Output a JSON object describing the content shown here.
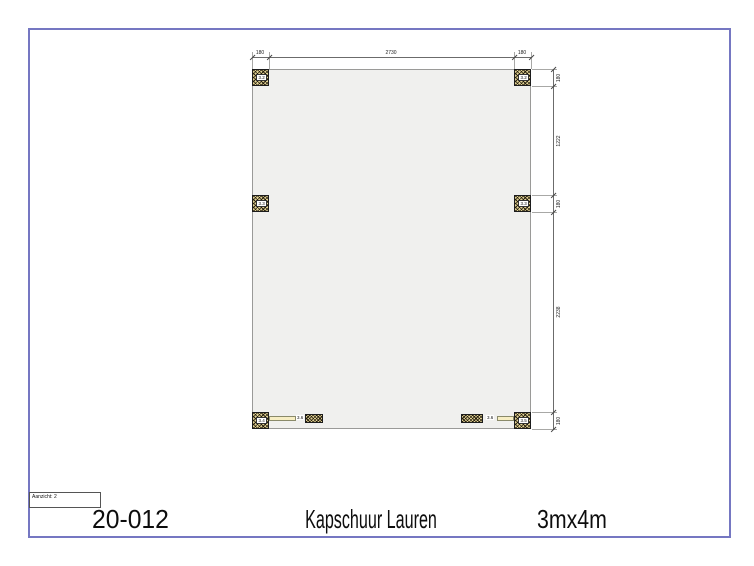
{
  "drawing": {
    "view_box_label": "Aanzicht: 2",
    "footer": {
      "project_number": "20-012",
      "title": "Kapschuur Lauren",
      "size": "3mx4m"
    },
    "colors": {
      "frame_border": "#7577c2",
      "floor_fill": "#f0f0ee",
      "wood_hatch_fill": "#e0d193",
      "beam_fill": "#f7eec3"
    },
    "posts": {
      "top_left": "3.2",
      "top_right": "3.2",
      "mid_left": "3.3",
      "mid_right": "3.3",
      "bottom_left": "3.4",
      "bottom_right": "3.5"
    },
    "beams": {
      "left": "3.6",
      "right": "3.6"
    },
    "dimensions": {
      "top": [
        "180",
        "2730",
        "180"
      ],
      "right": [
        "180",
        "1222",
        "180",
        "2238",
        "180"
      ]
    }
  }
}
